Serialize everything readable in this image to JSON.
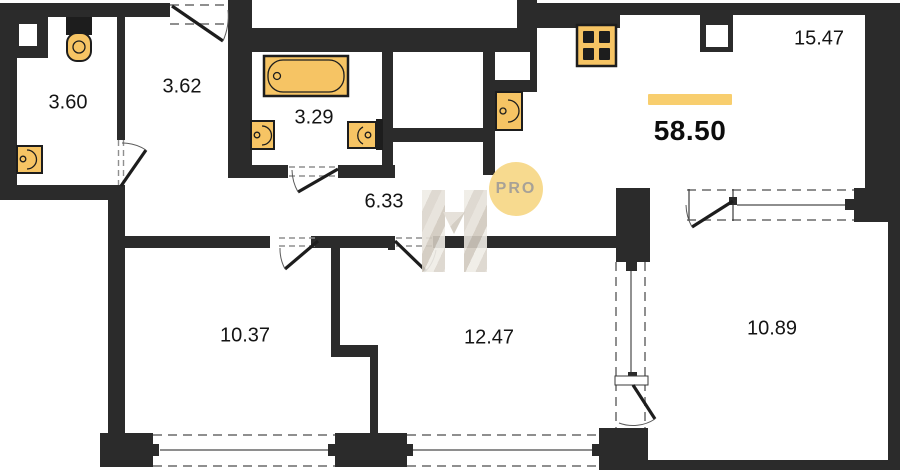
{
  "floorplan": {
    "total_area": "58.50",
    "watermark": {
      "badge": "PRO",
      "logo": "h-monogram"
    },
    "rooms": [
      {
        "name": "wc",
        "area": "3.60"
      },
      {
        "name": "entry-hall",
        "area": "3.62"
      },
      {
        "name": "bathroom",
        "area": "3.29"
      },
      {
        "name": "corridor",
        "area": "6.33"
      },
      {
        "name": "kitchen-living-room",
        "area": "15.47"
      },
      {
        "name": "room-left",
        "area": "10.37"
      },
      {
        "name": "room-middle",
        "area": "12.47"
      },
      {
        "name": "room-right",
        "area": "10.89"
      }
    ],
    "fixtures": [
      "toilet-icon",
      "bathtub-icon",
      "sink-icon",
      "sink-icon",
      "sink-icon",
      "sink-icon",
      "stove-icon"
    ],
    "colors": {
      "wall": "#2b2b2b",
      "fixture_fill": "#f6c464",
      "accent_bar": "#f8ce6e",
      "badge_fill": "#f7d98a",
      "badge_text": "#a39d92",
      "dash": "#8f8f8f"
    }
  }
}
